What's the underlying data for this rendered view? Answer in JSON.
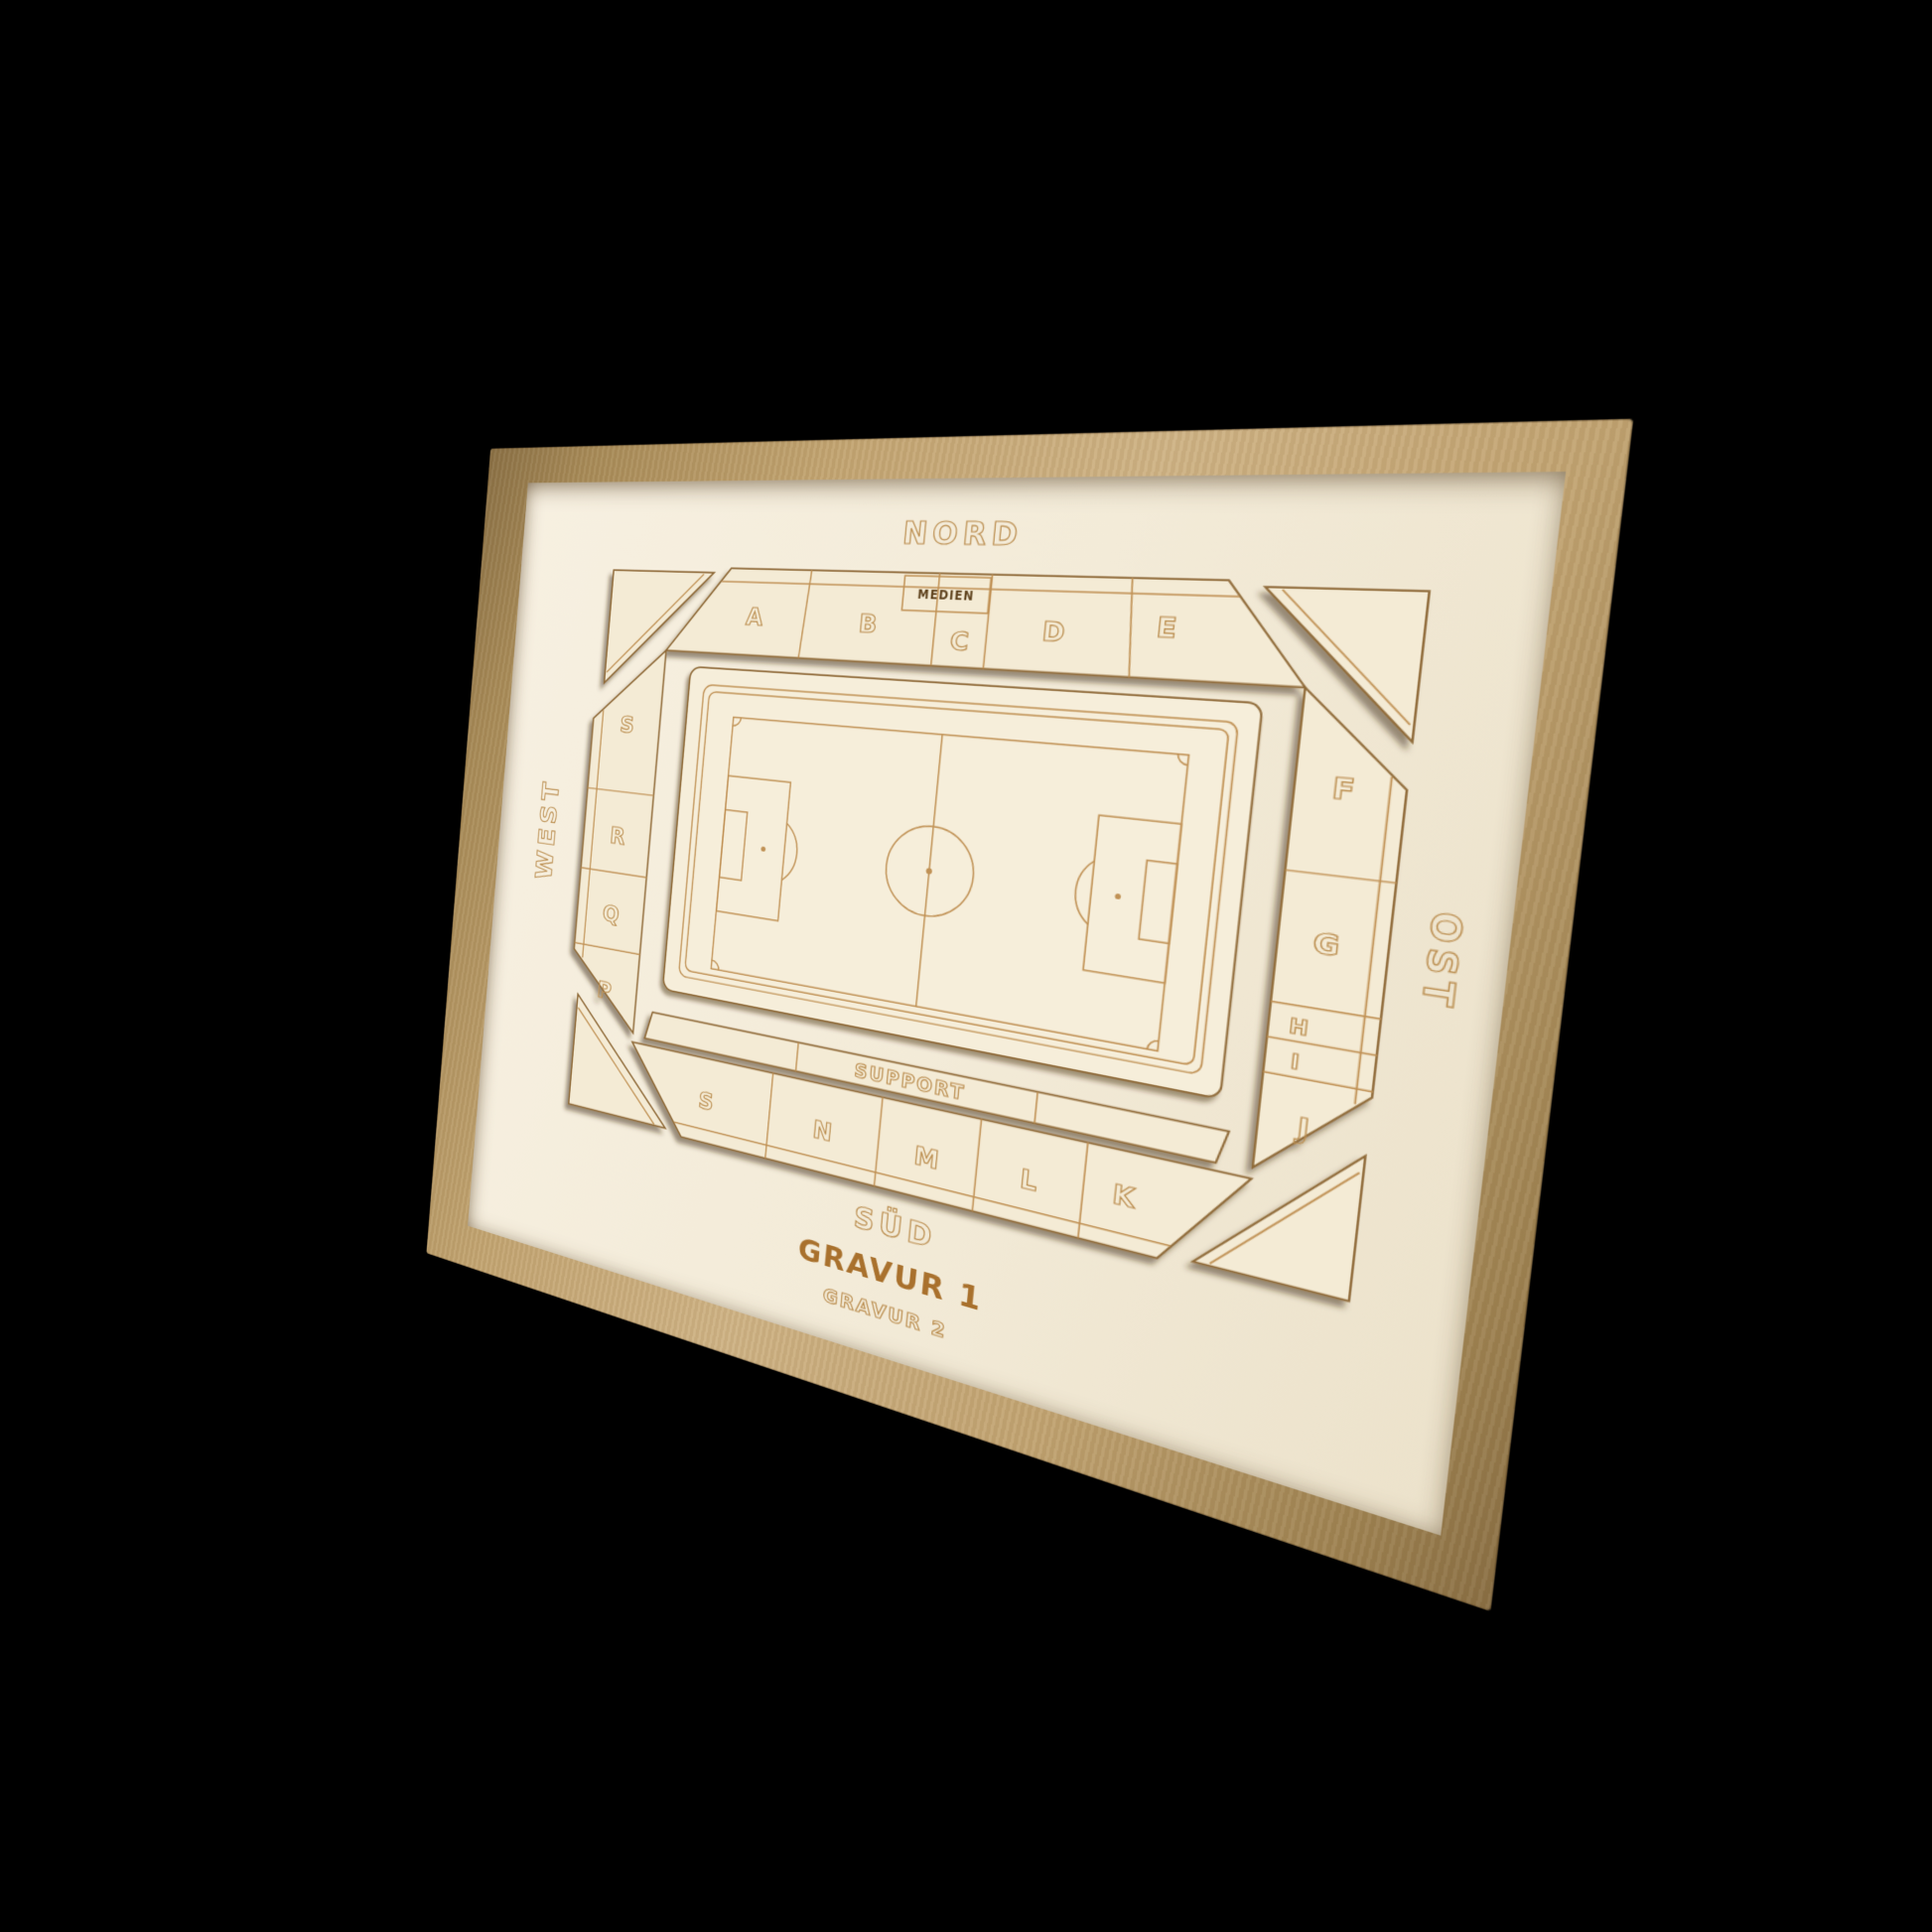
{
  "page": {
    "background": "#000000"
  },
  "colors": {
    "frame_wood": "#c3a572",
    "board_wood": "#f3ebd8",
    "engraving_line": "#c09154",
    "engraving_text_outline": "#bb8e50",
    "gravur1_text": "#a9712d",
    "media_box_text": "#5e421f"
  },
  "compass": {
    "north": "NORD",
    "east": "OST",
    "south": "SÜD",
    "west": "WEST"
  },
  "stands": {
    "north": {
      "sections": [
        "A",
        "B",
        "C",
        "D",
        "E"
      ],
      "box_label": "MEDIEN"
    },
    "east": {
      "sections": [
        "F",
        "G",
        "H",
        "I",
        "J"
      ]
    },
    "south": {
      "sections": [
        "S",
        "N",
        "M",
        "L",
        "K"
      ],
      "strip_label": "SUPPORT"
    },
    "west": {
      "sections": [
        "S",
        "R",
        "Q",
        "P"
      ]
    }
  },
  "engravings": {
    "line1": "GRAVUR 1",
    "line2": "GRAVUR 2"
  }
}
